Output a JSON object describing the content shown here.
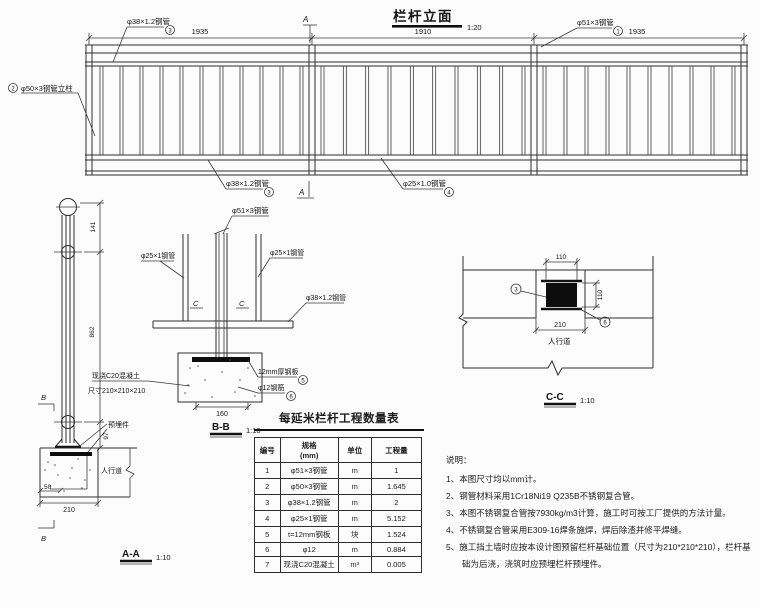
{
  "elevation": {
    "title": "栏杆立面",
    "scale": "1:20",
    "dim_left": "1935",
    "dim_mid": "1910",
    "dim_right": "1935",
    "handrail_label": "φ51×3钢管",
    "handrail_no": "1",
    "post_label": "φ50×3钢管立柱",
    "post_no": "2",
    "toprail_label": "φ38×1.2钢管",
    "toprail_no": "3",
    "botrail_label": "φ38×1.2钢管",
    "botrail_no": "3",
    "baluster_label": "φ25×1.0钢管",
    "baluster_no": "4",
    "section_mark": "A"
  },
  "section_aa": {
    "title": "A-A",
    "scale": "1:10",
    "dim_top": "141",
    "dim_mid": "862",
    "dim_bot": "97",
    "dim_width": "210",
    "dim_offset": "50",
    "embed_label": "预埋件",
    "sidewalk": "人行道",
    "mark": "B"
  },
  "section_bb": {
    "title": "B-B",
    "scale": "1:10",
    "dim_width": "160",
    "center_label": "φ51×3钢管",
    "left_label": "φ25×1钢管",
    "right_label": "φ25×1钢管",
    "rail_label": "φ38×1.2钢管",
    "plate_label": "12mm厚钢板",
    "plate_no": "5",
    "rebar_label": "φ12钢筋",
    "rebar_no": "6",
    "concrete_line1": "现浇C20混凝土",
    "concrete_line2": "尺寸210×210×210",
    "mark": "C"
  },
  "section_cc": {
    "title": "C-C",
    "scale": "1:10",
    "dim_top": "110",
    "dim_right": "110",
    "dim_bottom": "210",
    "sidewalk": "人行道",
    "left_no": "3",
    "right_no": "6"
  },
  "table": {
    "title": "每延米栏杆工程数量表",
    "headers": [
      "编号",
      "规格\n(mm)",
      "单位",
      "工程量"
    ],
    "rows": [
      [
        "1",
        "φ51×3钢管",
        "m",
        "1"
      ],
      [
        "2",
        "φ50×3钢管",
        "m",
        "1.645"
      ],
      [
        "3",
        "φ38×1.2钢管",
        "m",
        "2"
      ],
      [
        "4",
        "φ25×1钢管",
        "m",
        "5.152"
      ],
      [
        "5",
        "t=12mm钢板",
        "块",
        "1.524"
      ],
      [
        "6",
        "φ12",
        "m",
        "0.884"
      ],
      [
        "7",
        "现浇C20混凝土",
        "m³",
        "0.005"
      ]
    ]
  },
  "notes": {
    "title": "说明：",
    "items": [
      "1、本图尺寸均以mm计。",
      "2、钢管材料采用1Cr18Ni19 Q235B不锈钢复合管。",
      "3、本图不锈钢复合管按7930kg/m3计算，施工时可按工厂提供的方法计量。",
      "4、不锈钢复合管采用E309-16焊条施焊，焊后除渣并修平焊缝。",
      "5、施工挡土墙时应按本设计图预留栏杆基础位置（尺寸为210*210*210），栏杆基础为后浇，浇筑时应预埋栏杆预埋件。"
    ]
  }
}
